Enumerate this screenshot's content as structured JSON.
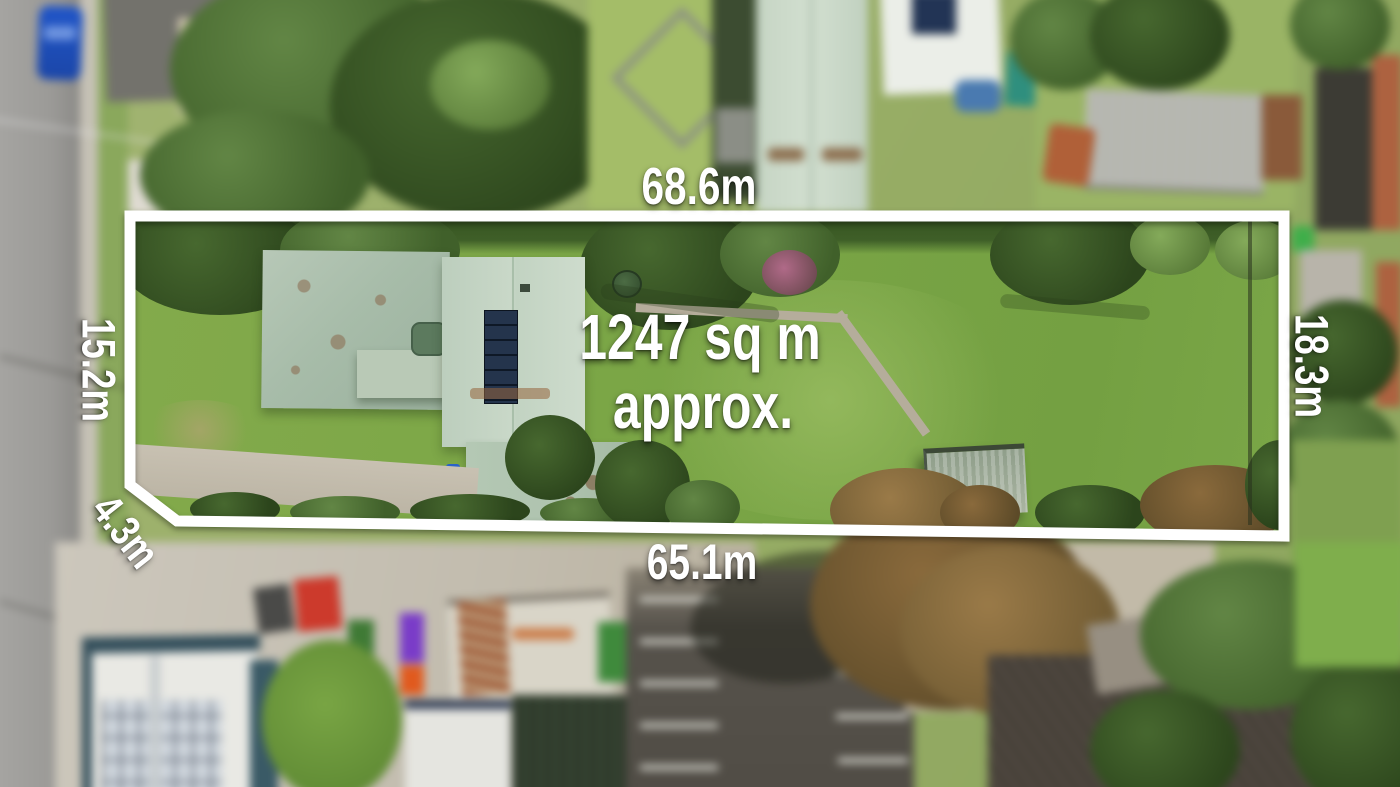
{
  "measurements": {
    "top": "68.6m",
    "bottom": "65.1m",
    "left": "15.2m",
    "right": "18.3m",
    "corner": "4.3m"
  },
  "area": {
    "line1": "1247 sq m",
    "line2": "approx."
  },
  "style": {
    "outline_color": "#ffffff",
    "label_color": "#ffffff"
  }
}
